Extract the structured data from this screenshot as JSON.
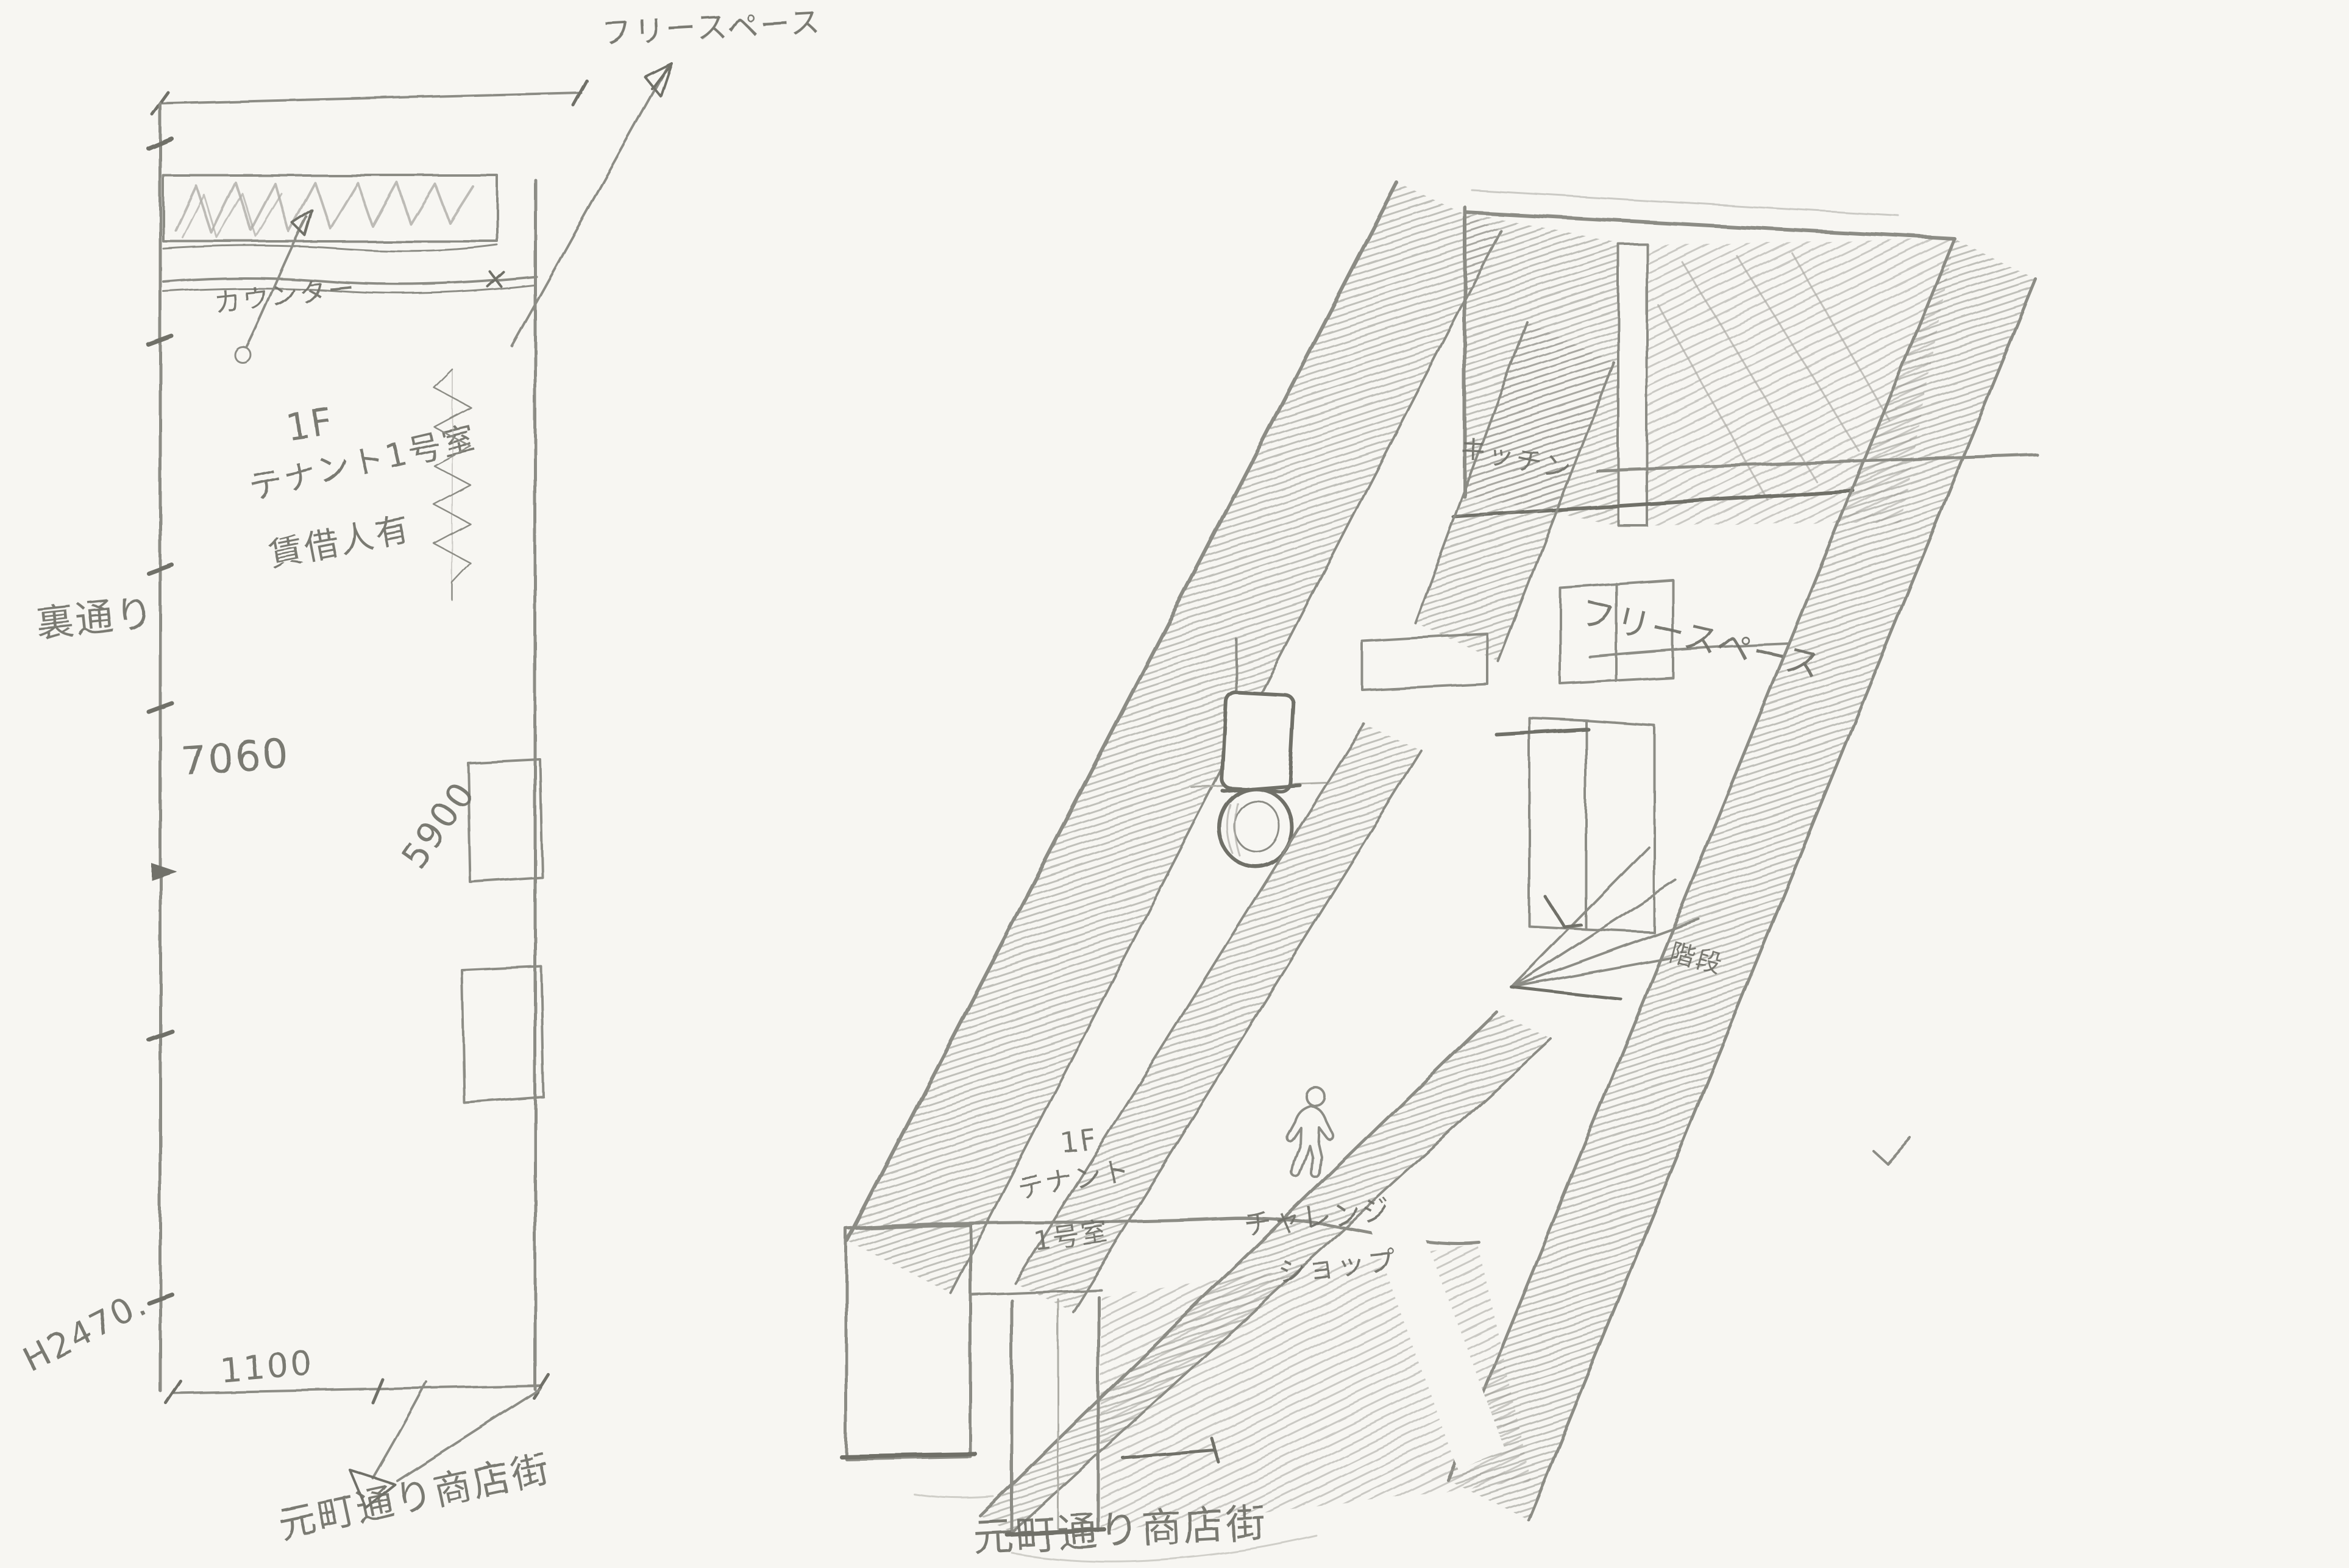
{
  "colors": {
    "paper": "#f7f6f2",
    "pencil": "#8c8c85",
    "pencil_dark": "#6f6f68",
    "pencil_light": "#aeada6"
  },
  "plan": {
    "arrow_label": "フリースペース",
    "counter_label": "カウンター",
    "room_line1": "1F",
    "room_line2": "テナント1号室",
    "room_line3": "賃借人有",
    "back_street": "裏通り",
    "dim_depth": "7060",
    "dim_opening": "5900",
    "dim_height": "H2470.",
    "dim_entrance": "1100",
    "street": "元町通り商店街"
  },
  "axon": {
    "kitchen": "キッチン",
    "free_space": "フリースペース",
    "stairs": "階段",
    "room_line1": "1F",
    "room_line2": "テナント",
    "room_line3": "1号室",
    "shop_line1": "チャレンジ",
    "shop_line2": "ショップ",
    "street": "元町通り商店街"
  }
}
